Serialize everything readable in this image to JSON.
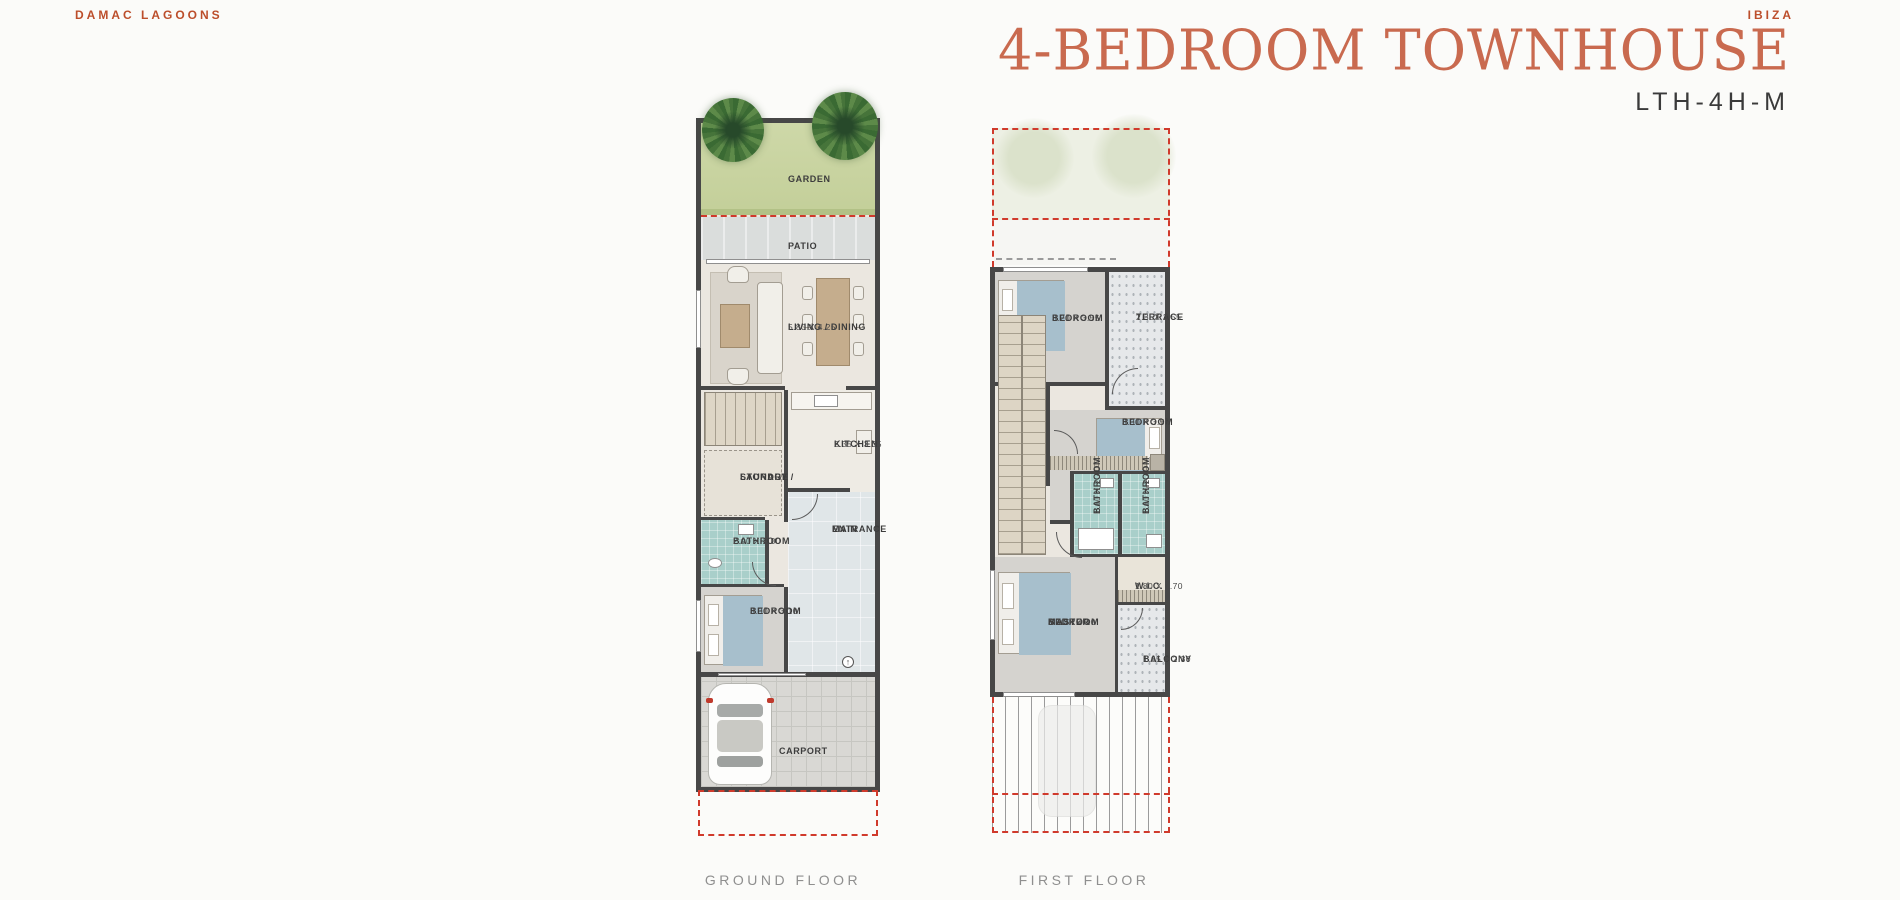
{
  "header": {
    "brand": "DAMAC LAGOONS",
    "project": "IBIZA",
    "title": "4-BEDROOM TOWNHOUSE",
    "unit_code": "LTH-4H-M"
  },
  "colors": {
    "brand_orange": "#bc4e2b",
    "title_coral": "#c96a4f",
    "unit_code_gray": "#3a3a3a",
    "plot_dash_red": "#d03a2c",
    "wall_dark": "#474747",
    "bathroom_teal": "#a9cfca",
    "garden_green": "#c9d4a2",
    "caption_gray": "#8f8f8f"
  },
  "ground_floor": {
    "caption": "GROUND FLOOR",
    "rooms": {
      "garden": {
        "name": "GARDEN"
      },
      "patio": {
        "name": "PATIO"
      },
      "living_dining": {
        "name": "LIVING / DINING",
        "dims": "5.80 X 4.25"
      },
      "kitchen": {
        "name": "KITCHEN",
        "dims": "2.35 X 3.35"
      },
      "laundry": {
        "line1": "LAUNDRY /",
        "line2": "STORAGE"
      },
      "bathroom": {
        "name": "BATHROOM",
        "dims": "2.00 X 2.00"
      },
      "main_entrance": {
        "line1": "MAIN",
        "line2": "ENTRANCE"
      },
      "bedroom": {
        "name": "BEDROOM",
        "dims": "3.30 X 3.10"
      },
      "carport": {
        "name": "CARPORT"
      }
    }
  },
  "first_floor": {
    "caption": "FIRST FLOOR",
    "rooms": {
      "bedroom1": {
        "name": "BEDROOM",
        "dims": "3.20 X 3.55"
      },
      "terrace": {
        "name": "TERRACE",
        "dims": "2.35X 3.55"
      },
      "bedroom2": {
        "name": "BEDROOM",
        "dims": "3.30 X 3.55"
      },
      "bathroom1": {
        "name": "BATHROOM",
        "dims": "1.60 X 2.40"
      },
      "bathroom2": {
        "name": "BATHROOM",
        "dims": "1.60 X 2.40"
      },
      "wic": {
        "name": "W.I.C.",
        "dims": "1.80 X 1.70"
      },
      "master_bedroom": {
        "line1": "MASTER",
        "line2": "BEDROOM",
        "dims": "3.90 X 4.10"
      },
      "balcony": {
        "name": "BALCONY",
        "dims": "1.65 X 2.30"
      }
    }
  }
}
